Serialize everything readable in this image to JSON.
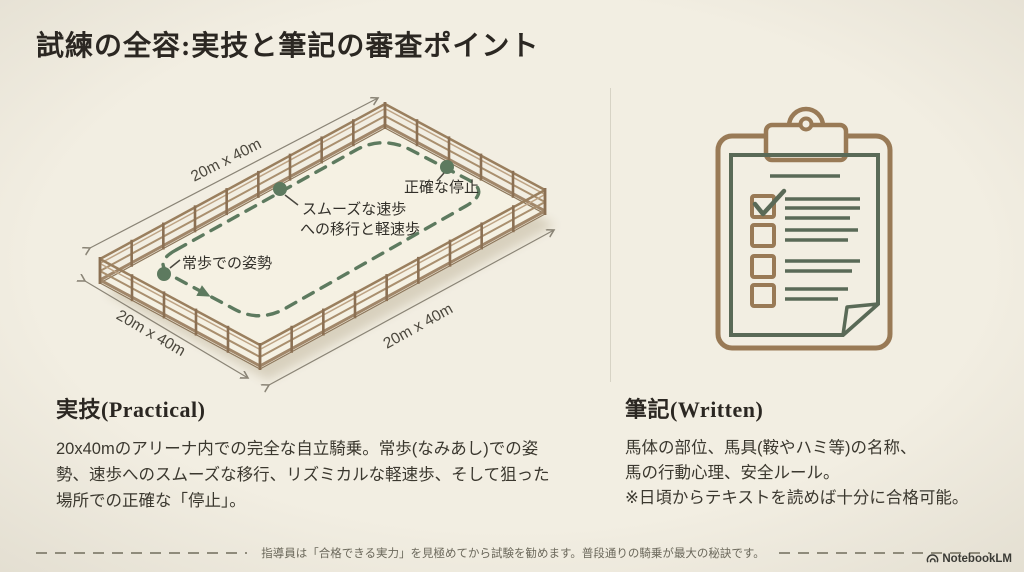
{
  "slide": {
    "title": "試練の全容:実技と筆記の審査ポイント"
  },
  "arena": {
    "dim_label_top": "20m x 40m",
    "dim_label_left": "20m x 40m",
    "dim_label_right": "20m x 40m",
    "checkpoint_stop": "正確な停止",
    "checkpoint_trot_line1": "スムーズな速歩",
    "checkpoint_trot_line2": "への移行と軽速歩",
    "checkpoint_walk": "常歩での姿勢"
  },
  "practical": {
    "heading": "実技(Practical)",
    "body": "20x40mのアリーナ内での完全な自立騎乗。常歩(なみあし)での姿勢、速歩へのスムーズな移行、リズミカルな軽速歩、そして狙った場所での正確な「停止」。"
  },
  "written": {
    "heading": "筆記(Written)",
    "body_line1": "馬体の部位、馬具(鞍やハミ等)の名称、",
    "body_line2": "馬の行動心理、安全ルール。",
    "body_line3": "※日頃からテキストを読めば十分に合格可能。"
  },
  "footer": {
    "note": "指導員は「合格できる実力」を見極めてから試験を勧めます。普段通りの騎乗が最大の秘訣です。",
    "brand": "NotebookLM"
  },
  "colors": {
    "background": "#f2eee2",
    "accent_green": "#5d7a5f",
    "wood_brown": "#9a7f5e",
    "clipboard_brown": "#997a56",
    "paper_green": "#5a6a57",
    "ink": "#2b2722"
  }
}
